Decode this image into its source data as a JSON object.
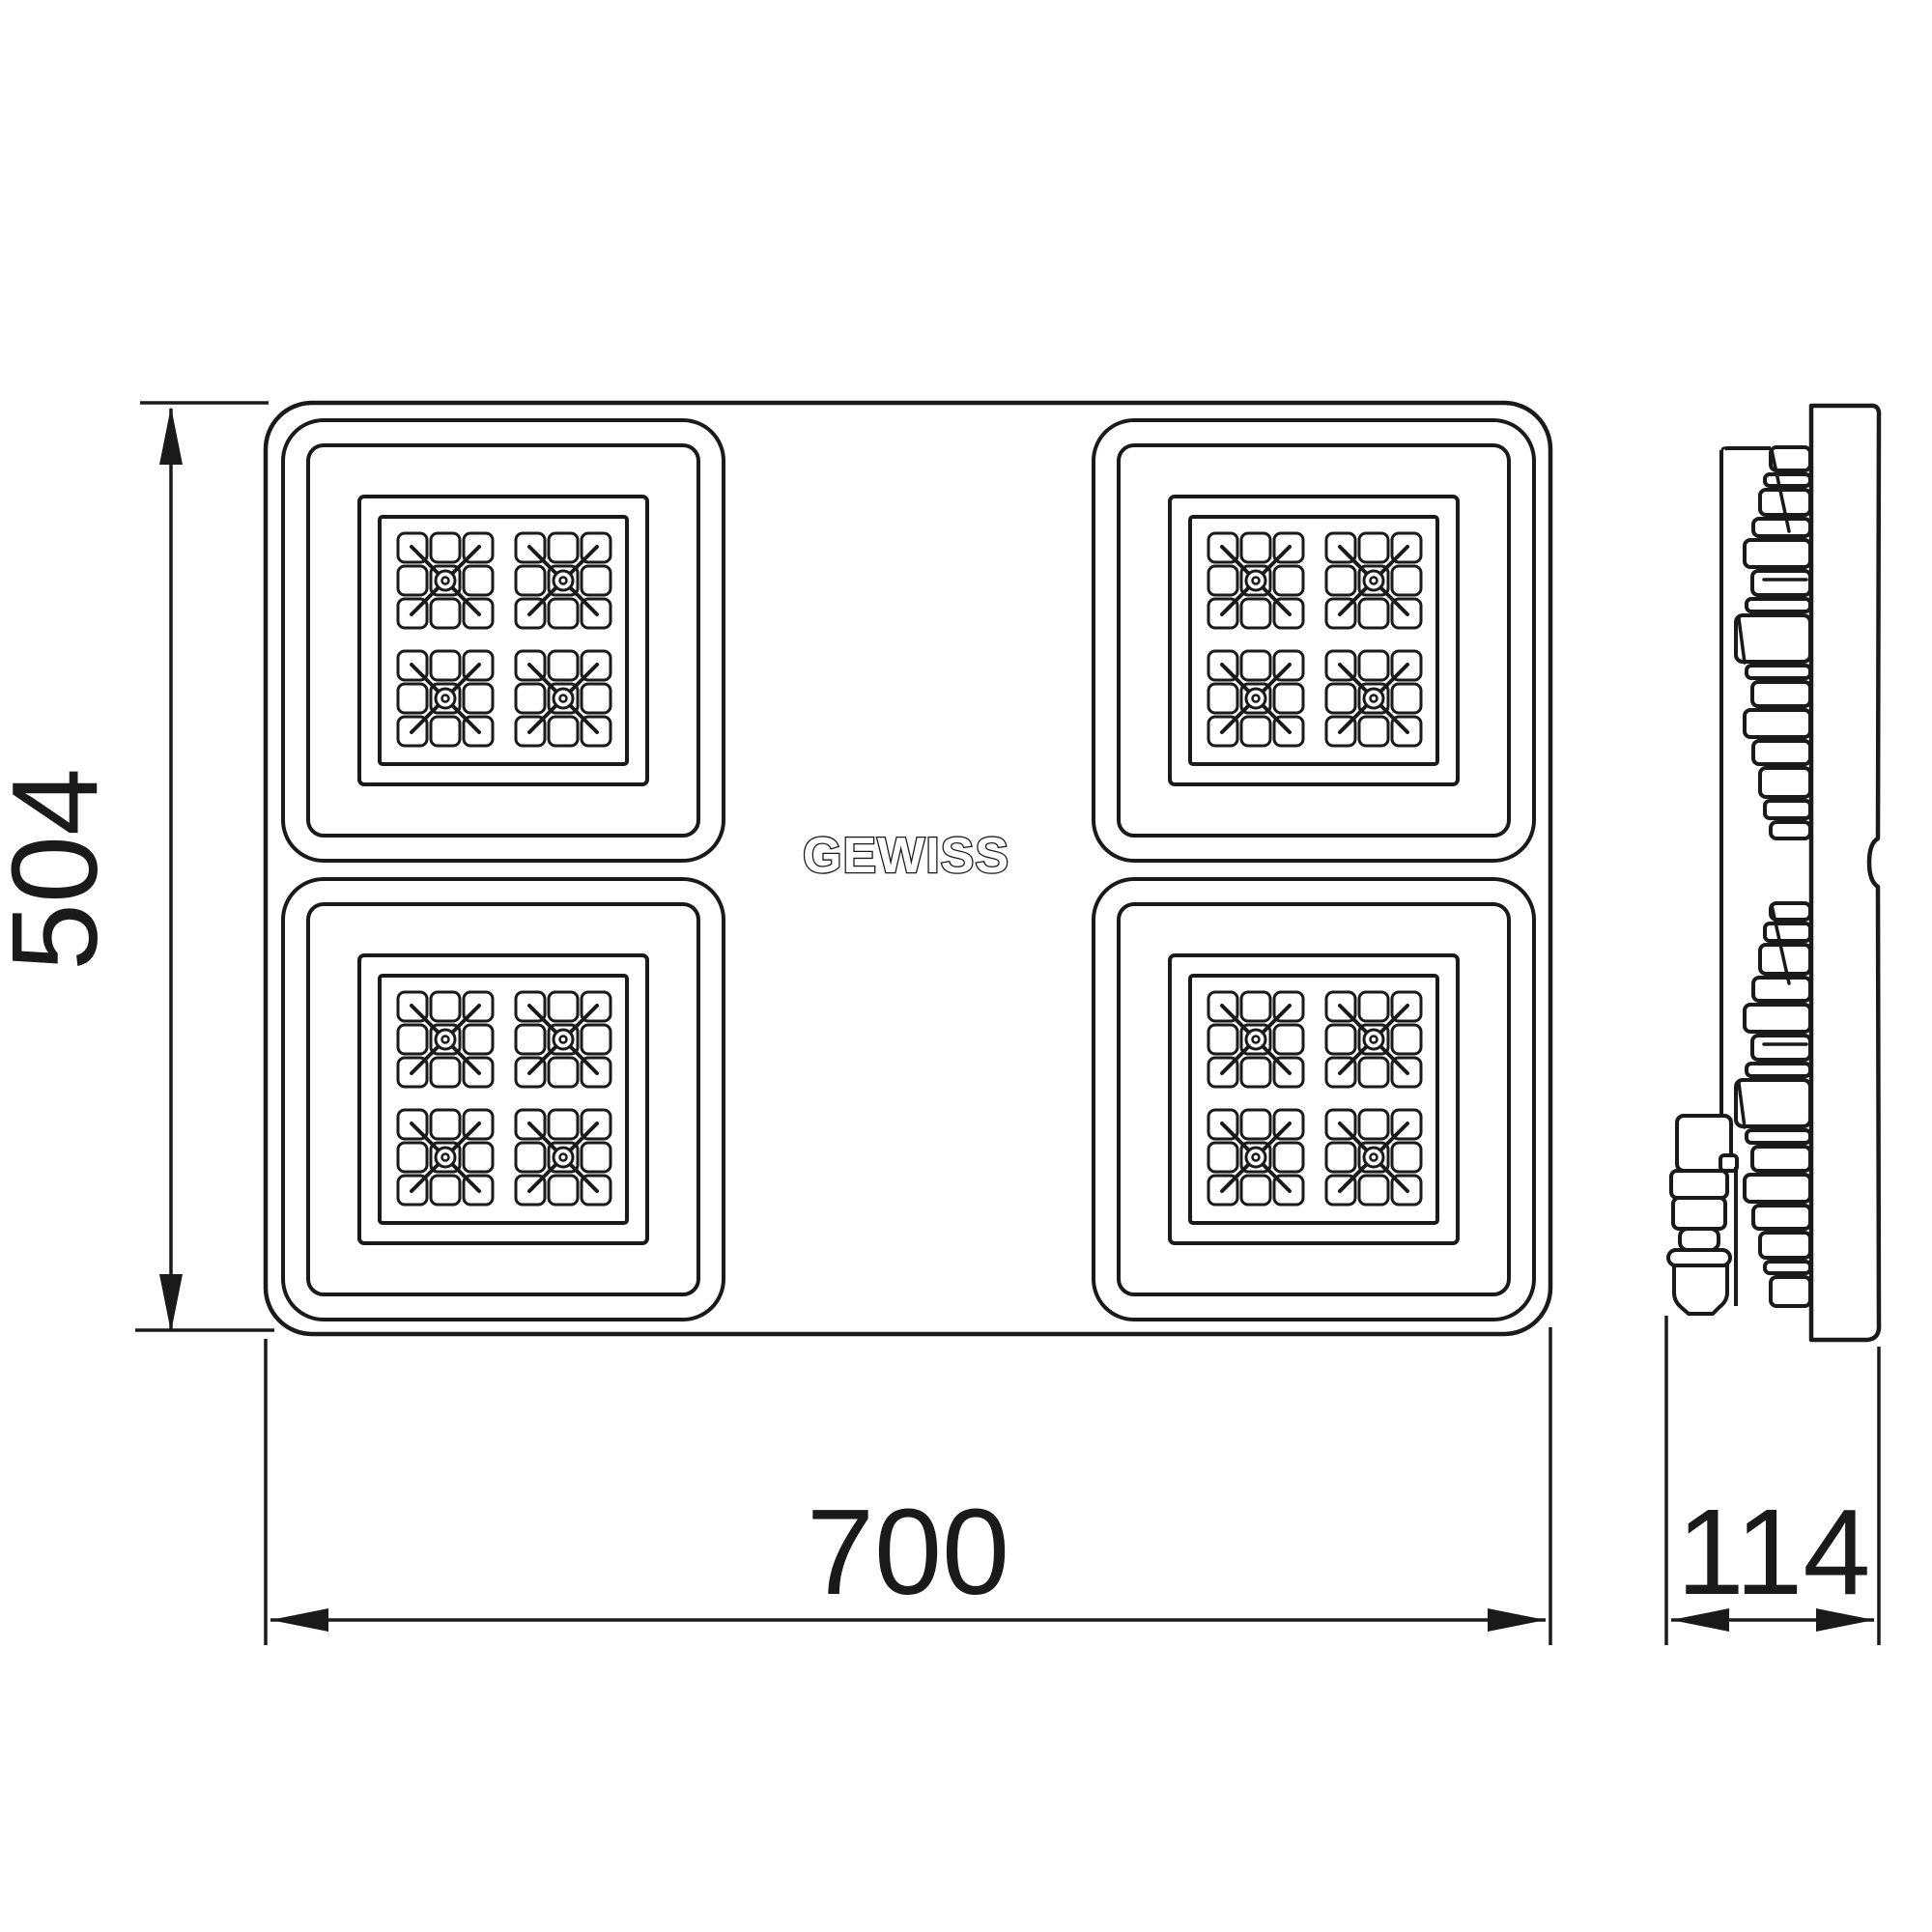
{
  "logo": {
    "text": "GEWISS"
  },
  "dimensions": {
    "height_mm": "504",
    "width_mm": "700",
    "depth_mm": "114"
  },
  "front_view": {
    "module_count": 4,
    "clusters_per_module": 4,
    "cluster_grid": "3x3"
  },
  "colors": {
    "line": "#1a1a1a",
    "background": "#ffffff"
  }
}
